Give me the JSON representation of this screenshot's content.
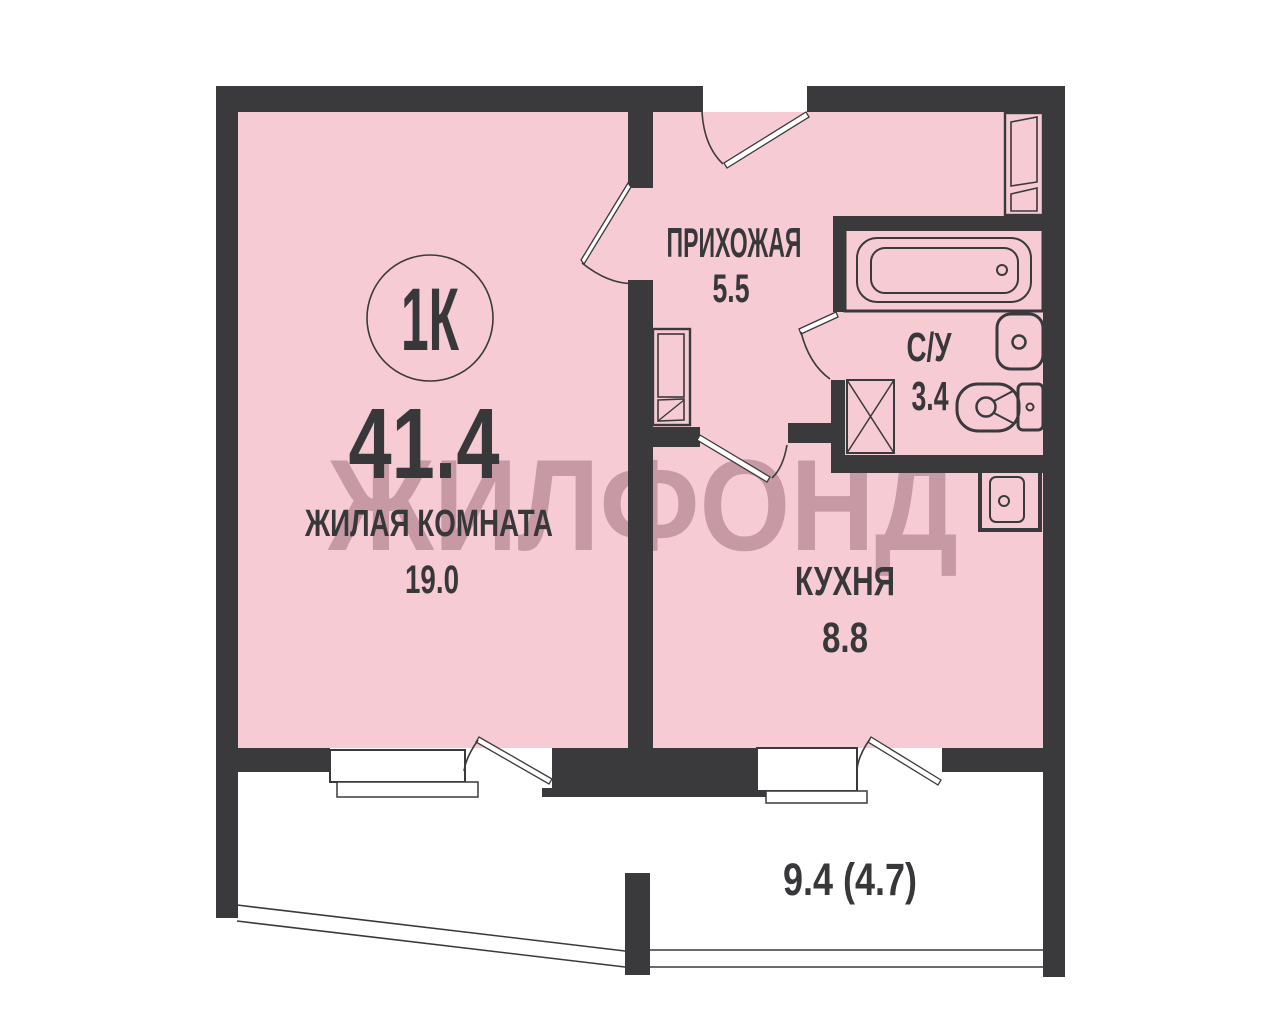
{
  "plan": {
    "badge": {
      "label": "1К",
      "total_area": "41.4"
    },
    "rooms": {
      "living": {
        "name": "ЖИЛАЯ КОМНАТА",
        "area": "19.0"
      },
      "hallway": {
        "name": "ПРИХОЖАЯ",
        "area": "5.5"
      },
      "bathroom": {
        "name": "С/У",
        "area": "3.4"
      },
      "kitchen": {
        "name": "КУХНЯ",
        "area": "8.8"
      },
      "balcony": {
        "area": "9.4 (4.7)"
      }
    },
    "fixtures": [
      "bathtub",
      "washbasin",
      "toilet",
      "ventilation-shaft",
      "kitchen-sink",
      "wardrobe",
      "hallway-cabinet",
      "window",
      "balcony-door",
      "entrance-door"
    ],
    "watermark": {
      "text": "ЖИЛФОНД"
    },
    "colors": {
      "wall": "#3a3a3c",
      "room": "#f6cbd4",
      "ink": "#38383a",
      "wm": "#7a4a58",
      "bg": "#ffffff"
    }
  }
}
